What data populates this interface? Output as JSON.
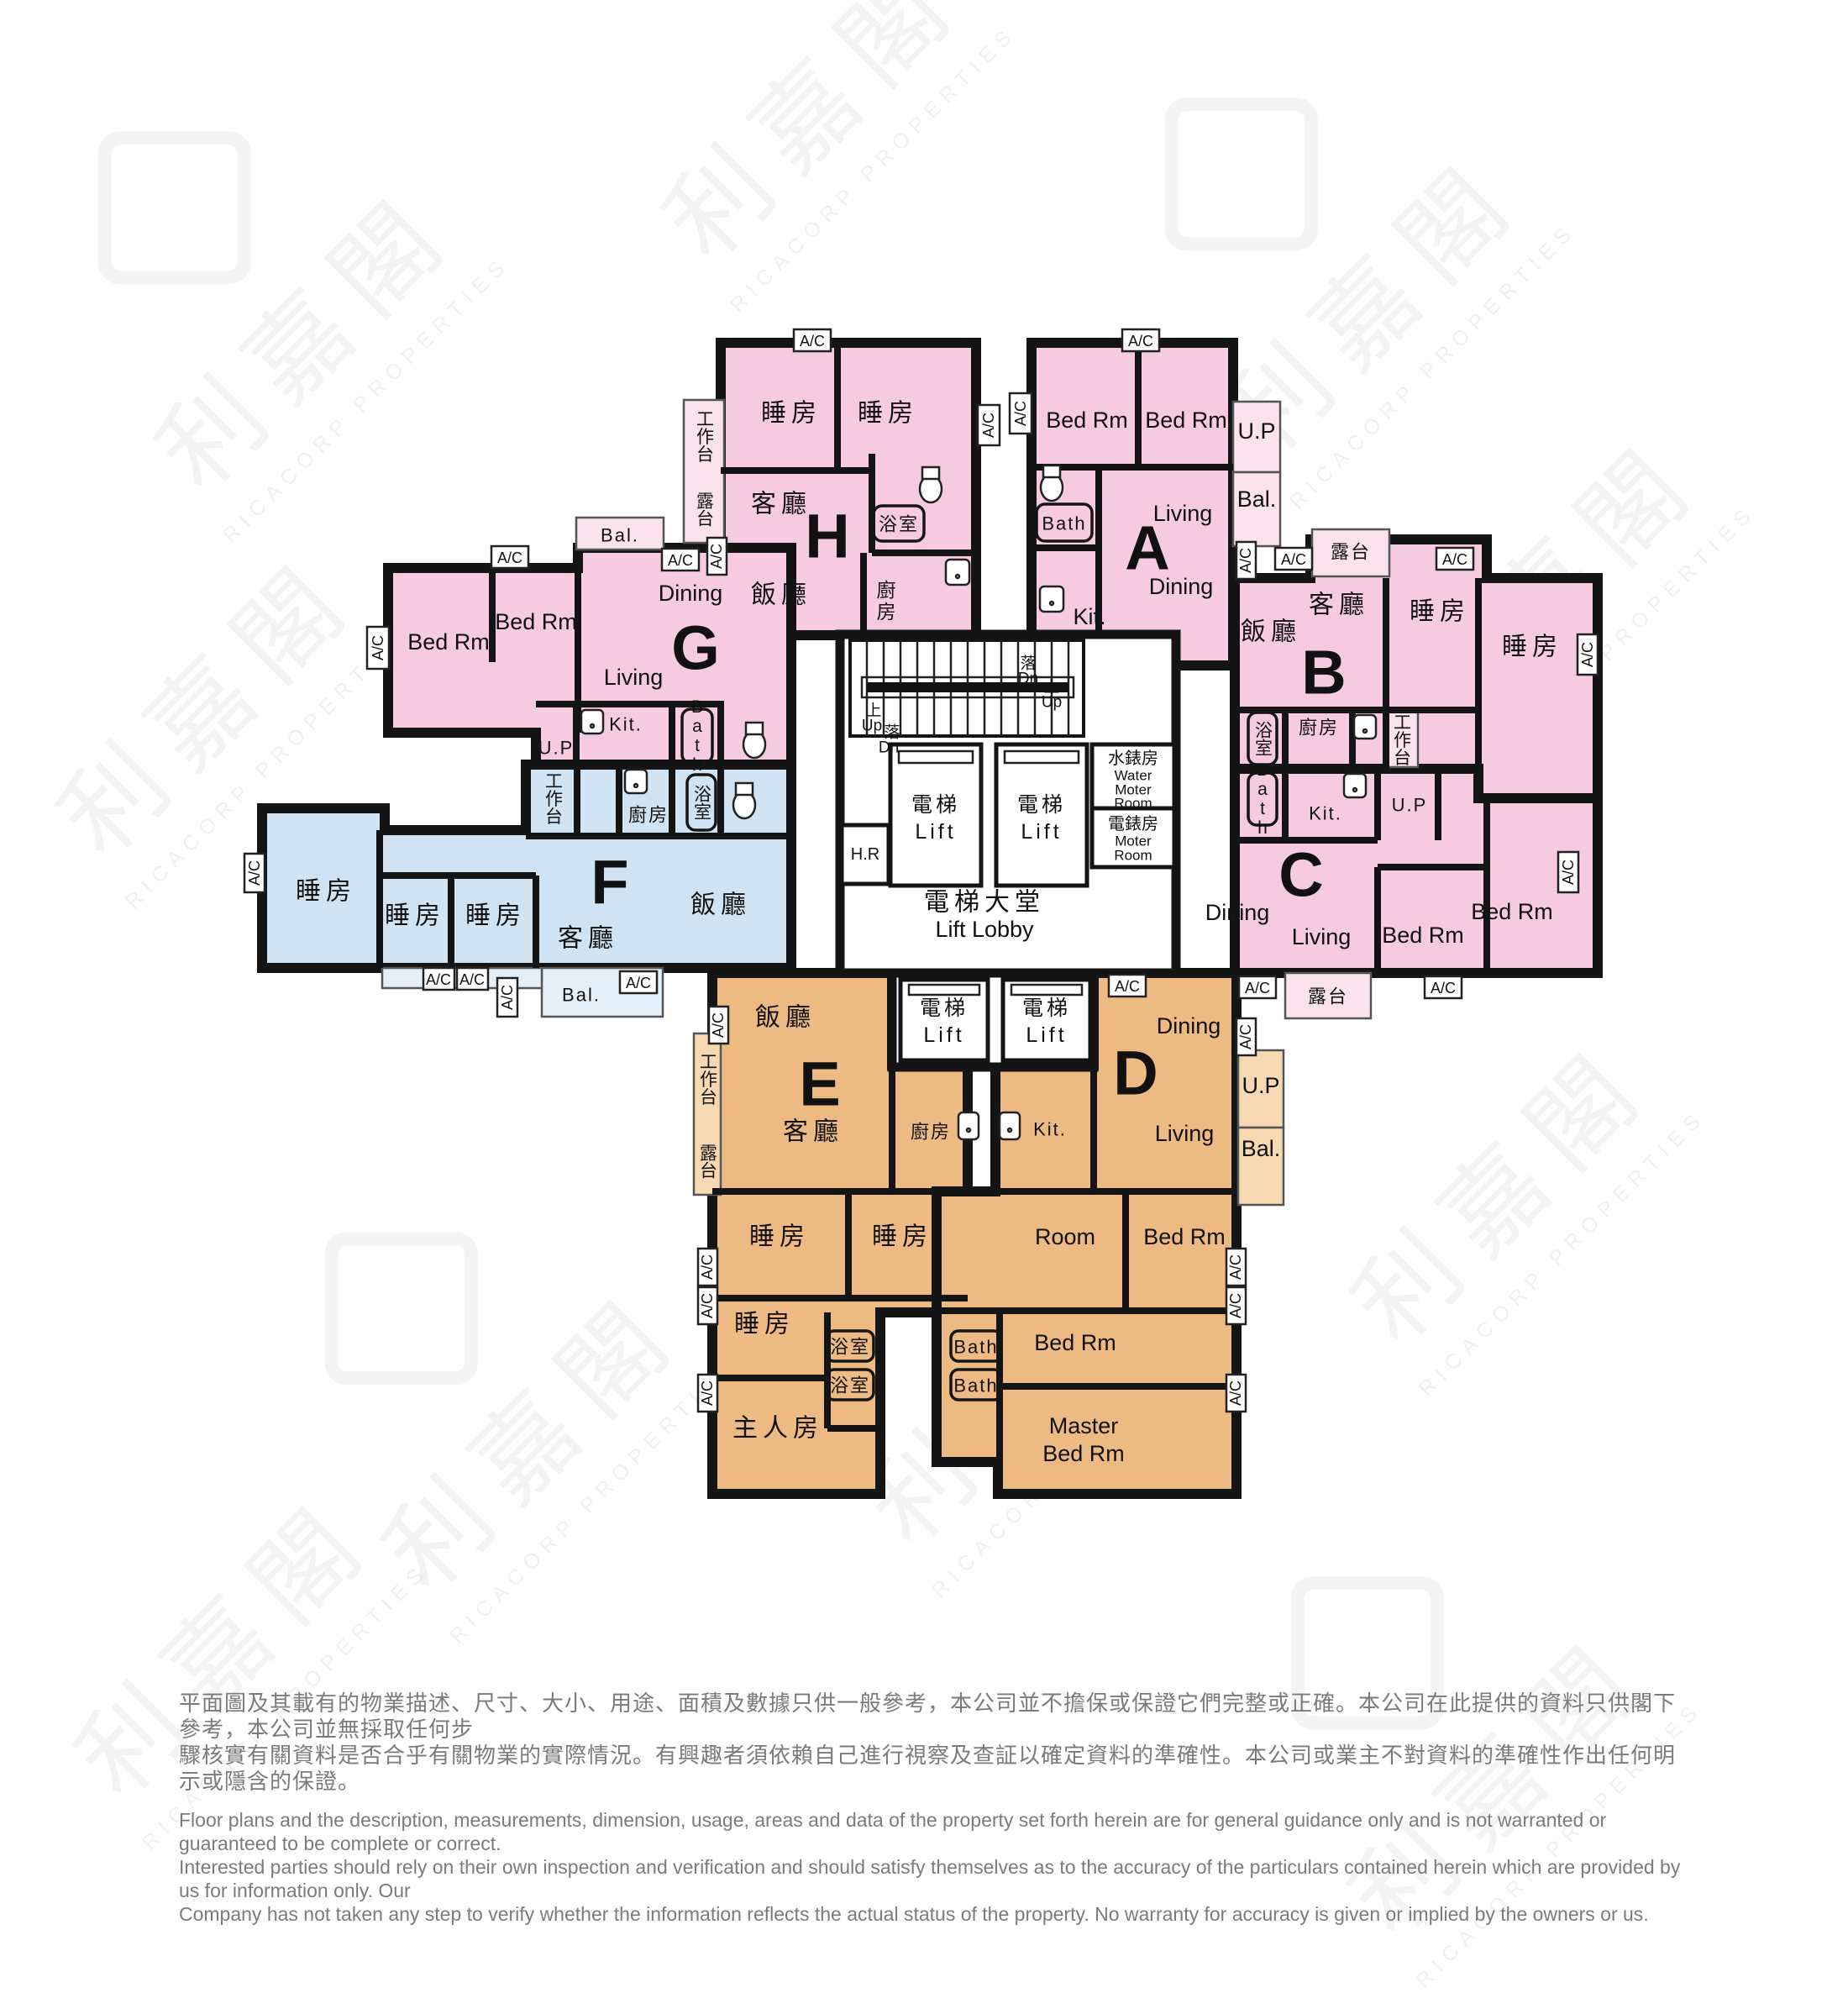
{
  "watermark": {
    "cjk": "利嘉閣",
    "latin": "RICACORP PROPERTIES"
  },
  "units": {
    "a": "A",
    "b": "B",
    "c": "C",
    "d": "D",
    "e": "E",
    "f": "F",
    "g": "G",
    "h": "H"
  },
  "rooms": {
    "bedroom_cjk": "睡房",
    "bedroom_en": "Bed Rm",
    "master_cjk": "主人房",
    "master_en_1": "Master",
    "master_en_2": "Bed Rm",
    "room_en": "Room",
    "living_cjk": "客廳",
    "living_en": "Living",
    "dining_cjk": "飯廳",
    "dining_en": "Dining",
    "kitchen_cjk": "廚房",
    "kitchen_en": "Kit.",
    "bath_cjk": "浴室",
    "bath_en": "Bath",
    "balcony_cjk": "露台",
    "balcony_en": "Bal.",
    "utility": "U.P",
    "worktop_cjk": "工作台",
    "ac": "A/C"
  },
  "core": {
    "lift_cjk": "電梯",
    "lift_en": "Lift",
    "lobby_cjk": "電梯大堂",
    "lobby_en": "Lift Lobby",
    "hr": "H.R",
    "water_meter_cjk": "水錶房",
    "water_meter_en_1": "Water",
    "water_meter_en_2": "Moter",
    "water_meter_en_3": "Room",
    "elec_meter_cjk": "電錶房",
    "elec_meter_en_1": "Moter",
    "elec_meter_en_2": "Room",
    "up_cjk": "上",
    "up_en": "Up",
    "down_cjk": "落",
    "down_en": "Dn"
  },
  "colors": {
    "pink": "#F6CBDF",
    "pink_light": "#FBE3EE",
    "blue": "#CFE3F2",
    "blue_light": "#E4F0F9",
    "orange": "#EDBA84",
    "orange_light": "#F6D8B2",
    "wall": "#141414",
    "disclaimer_text": "#7B7B7B"
  },
  "disclaimer": {
    "zh_1": "平面圖及其載有的物業描述、尺寸、大小、用途、面積及數據只供一般參考，本公司並不擔保或保證它們完整或正確。本公司在此提供的資料只供閣下參考，本公司並無採取任何步",
    "zh_2": "驟核實有關資料是否合乎有關物業的實際情況。有興趣者須依賴自己進行視察及查証以確定資料的準確性。本公司或業主不對資料的準確性作出任何明示或隱含的保證。",
    "en_1": "Floor plans and the description, measurements, dimension, usage, areas and data of the property set forth herein are for general guidance only and is not warranted or guaranteed to be complete or correct.",
    "en_2": "Interested parties should rely on their own inspection and verification and should satisfy themselves as to the accuracy of the particulars contained herein which are provided by us for information only.  Our",
    "en_3": "Company has not taken any step to verify whether the information reflects the actual status of the property.  No warranty for accuracy is given or implied by the owners or us."
  }
}
